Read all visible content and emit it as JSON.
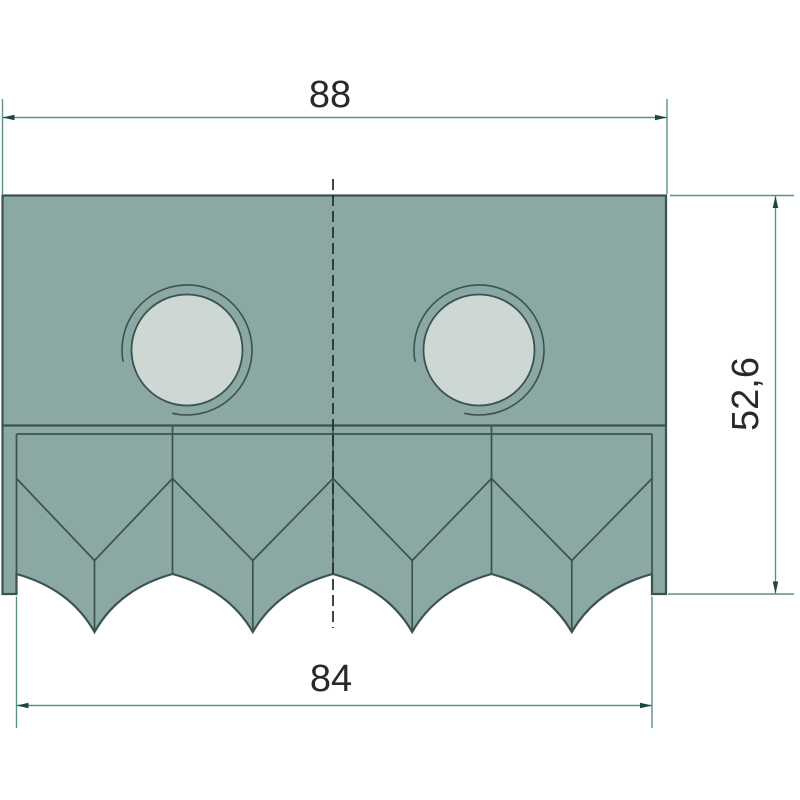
{
  "dimensions": {
    "top_width": "88",
    "bottom_width": "84",
    "side_height": "52,6"
  },
  "colors": {
    "background": "#FFFFFF",
    "part-fill": "#8BA8A4",
    "hole-fill": "#CDD7D3",
    "line-dark": "#3A534F",
    "dim-line": "#5A918A",
    "arrow": "#1F4540",
    "centerline": "#2B2F2E",
    "text": "#272A29"
  }
}
